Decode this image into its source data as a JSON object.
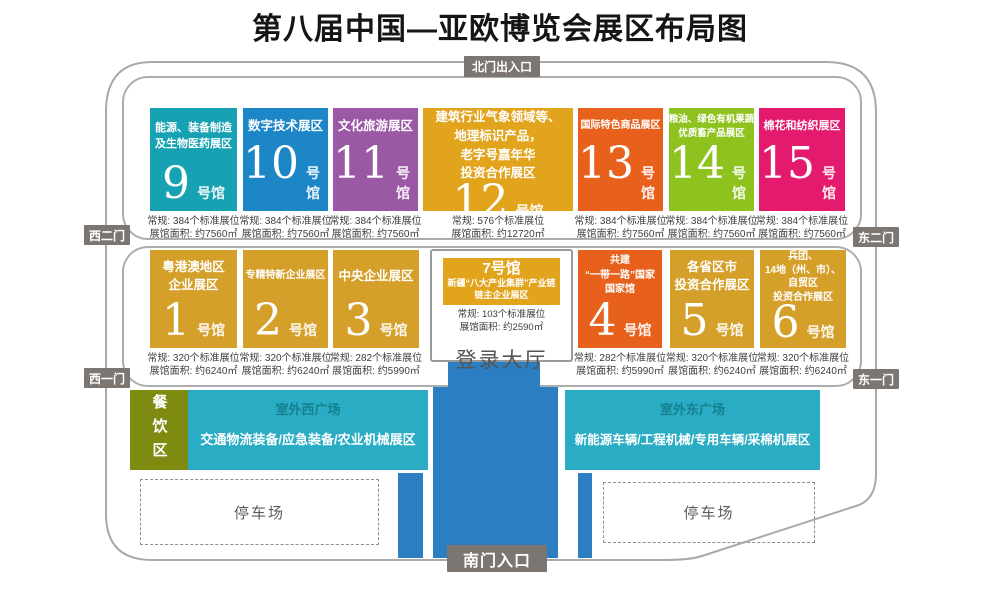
{
  "title": "第八届中国—亚欧博览会展区布局图",
  "colors": {
    "teal_hall": "#17a2b3",
    "blue_hall": "#1c86c6",
    "purple_hall": "#9a58a5",
    "amber_hall": "#e2a31d",
    "orange_hall": "#e7611d",
    "green_hall": "#8ec31f",
    "pink_hall": "#e31a6e",
    "gold_hall": "#d5a02a",
    "plaza_teal": "#2aacc5",
    "plaza_title_text": "#15808f",
    "dining_olive": "#7f8b10",
    "road_blue": "#2a7ec1",
    "gate_gray": "#7c7672"
  },
  "gates": {
    "north": "北门出入口",
    "south": "南门入口",
    "west_gate2": "西二门",
    "west_gate1": "西一门",
    "east_gate2": "东二门",
    "east_gate1": "东一门"
  },
  "halls_row1": [
    {
      "num": "9",
      "suffix": "号馆",
      "name": "能源、装备制造\n及生物医药展区",
      "booths": "常规: 384个标准展位",
      "area": "展馆面积: 约7560㎡",
      "color": "#17a2b3"
    },
    {
      "num": "10",
      "suffix": "号馆",
      "name": "数字技术展区",
      "booths": "常规: 384个标准展位",
      "area": "展馆面积: 约7560㎡",
      "color": "#1c86c6"
    },
    {
      "num": "11",
      "suffix": "号馆",
      "name": "文化旅游展区",
      "booths": "常规: 384个标准展位",
      "area": "展馆面积: 约7560㎡",
      "color": "#9a58a5"
    },
    {
      "num": "12",
      "suffix": "号馆",
      "name": "建筑行业气象领域等、\n地理标识产品，\n老字号嘉年华\n投资合作展区",
      "booths": "常规: 576个标准展位",
      "area": "展馆面积: 约12720㎡",
      "color": "#e2a31d"
    },
    {
      "num": "13",
      "suffix": "号馆",
      "name": "国际特色商品展区",
      "booths": "常规: 384个标准展位",
      "area": "展馆面积: 约7560㎡",
      "color": "#e7611d"
    },
    {
      "num": "14",
      "suffix": "号馆",
      "name": "粮油、绿色有机果蔬\n优质畜产品展区",
      "booths": "常规: 384个标准展位",
      "area": "展馆面积: 约7560㎡",
      "color": "#8ec31f"
    },
    {
      "num": "15",
      "suffix": "号馆",
      "name": "棉花和纺织展区",
      "booths": "常规: 384个标准展位",
      "area": "展馆面积: 约7560㎡",
      "color": "#e31a6e"
    }
  ],
  "halls_row2": [
    {
      "num": "1",
      "suffix": "号馆",
      "name": "粤港澳地区\n企业展区",
      "booths": "常规: 320个标准展位",
      "area": "展馆面积: 约6240㎡",
      "color": "#d5a02a"
    },
    {
      "num": "2",
      "suffix": "号馆",
      "name": "专精特新企业展区",
      "booths": "常规: 320个标准展位",
      "area": "展馆面积: 约6240㎡",
      "color": "#d5a02a"
    },
    {
      "num": "3",
      "suffix": "号馆",
      "name": "中央企业展区",
      "booths": "常规: 282个标准展位",
      "area": "展馆面积: 约5990㎡",
      "color": "#d5a02a"
    },
    {
      "num": "4",
      "suffix": "号馆",
      "name": "共建\n“一带一路”国家\n国家馆",
      "booths": "常规: 282个标准展位",
      "area": "展馆面积: 约5990㎡",
      "color": "#e7611d"
    },
    {
      "num": "5",
      "suffix": "号馆",
      "name": "各省区市\n投资合作展区",
      "booths": "常规: 320个标准展位",
      "area": "展馆面积: 约6240㎡",
      "color": "#d5a02a"
    },
    {
      "num": "6",
      "suffix": "号馆",
      "name": "兵团、\n14地（州、市）、\n自贸区\n投资合作展区",
      "booths": "常规: 320个标准展位",
      "area": "展馆面积: 约6240㎡",
      "color": "#d5a02a"
    }
  ],
  "hall7": {
    "header": "7号馆",
    "name": "新疆“八大产业集群”产业链\n链主企业展区",
    "booths": "常规: 103个标准展位",
    "area": "展馆面积: 约2590㎡",
    "color": "#e2a31d"
  },
  "lobby_label": "登录大厅",
  "outdoor": {
    "dining_label": "餐饮区",
    "west_plaza_title": "室外西广场",
    "west_plaza_label": "交通物流装备/应急装备/农业机械展区",
    "east_plaza_title": "室外东广场",
    "east_plaza_label": "新能源车辆/工程机械/专用车辆/采棉机展区",
    "west_parking_label": "停车场",
    "east_parking_label": "停车场"
  }
}
